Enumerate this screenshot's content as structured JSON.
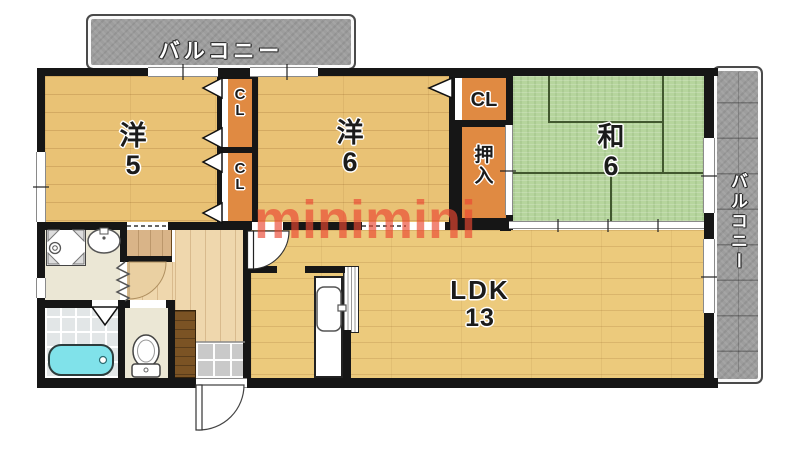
{
  "watermark": "minimini",
  "balcony_top": {
    "label": "バルコニー"
  },
  "balcony_right": {
    "label": "バルコニー"
  },
  "rooms": {
    "western5": {
      "label": "洋5"
    },
    "western6": {
      "label": "洋6"
    },
    "japanese6": {
      "label": "和6"
    },
    "ldk": {
      "label": "LDK",
      "size": "13"
    },
    "closet_left_top": {
      "label": "CL"
    },
    "closet_left_bottom": {
      "label": "CL"
    },
    "closet_right": {
      "label": "CL"
    },
    "oshiire": {
      "label": "押入"
    }
  },
  "colors": {
    "wall": "#161616",
    "wood_room": "#e9c275",
    "wood_ldk": "#ecca7c",
    "wood_hall": "#efd7ad",
    "tatami": "#b6d59d",
    "closet_orange": "#e08a42",
    "balcony_gray": "#9d9d9d",
    "bathtub_cyan": "#80e2ea",
    "entrance_tile": "#c9c9c9",
    "watermark_red": "#ea4832"
  }
}
